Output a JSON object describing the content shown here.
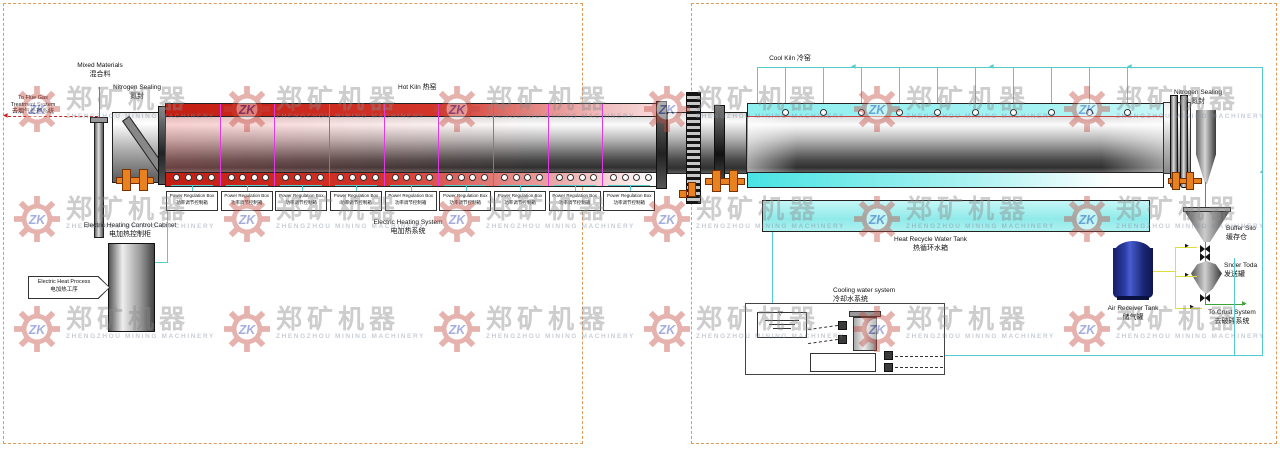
{
  "watermark": {
    "logo": "ZK",
    "brand_cn": "郑矿机器",
    "brand_en": "ZHENGZHOU MINING MACHINERY",
    "rows": 3,
    "cols": 6
  },
  "left": {
    "mixed_materials": {
      "en": "Mixed Materials",
      "cn": "混合料"
    },
    "flue_gas": {
      "l1": "To Flue Gas",
      "l2": "Treatment System",
      "cn": "去烟气处理系统"
    },
    "nitrogen_sealing": {
      "en": "Nitrogen Sealing",
      "cn": "氮封"
    },
    "hot_kiln": {
      "en": "Hot Kiln",
      "cn": "热窑"
    },
    "heating_zones": 9,
    "power_box": {
      "en": "Power Regulation Box",
      "cn": "功率调节控制箱"
    },
    "electric_heating_system": {
      "en": "Electric Heating System",
      "cn": "电加热系统"
    },
    "control_cabinet": {
      "en": "Electric Heating Control Cabinet",
      "cn": "电加热控制柜"
    },
    "heat_process": {
      "en": "Electric Heat Process",
      "cn": "电加热工序"
    }
  },
  "right": {
    "cool_kiln": {
      "en": "Cool Kiln",
      "cn": "冷窑"
    },
    "nitrogen_sealing": {
      "en": "Nitrogen Sealing",
      "cn": "氮封"
    },
    "water_tank": {
      "en": "Heat Recycle Water Tank",
      "cn": "热循环水箱"
    },
    "cooling_system": {
      "en": "Cooling water system",
      "cn": "冷却水系统"
    },
    "air_tank": {
      "en": "Air Receiver Tank",
      "cn": "储气罐"
    },
    "buffer_silo": {
      "en": "Buffer Silo",
      "cn": "缓存仓"
    },
    "sender_tank": {
      "en": "Snder Toda",
      "cn": "发送罐"
    },
    "to_crush": {
      "en": "To Crust System",
      "cn": "去破碎系统"
    },
    "spray_nozzles": 10
  },
  "colors": {
    "hot_red": "#d23020",
    "cool_cyan": "#8fefef",
    "pipe_cyan": "#55cccc",
    "flow_green": "#3aa53a",
    "air_yellow": "#dede3c",
    "zone_magenta": "#e23ae2",
    "roller_orange": "#e8821e",
    "border_dashed": "#e09a5a",
    "tank_blue": "#27379e"
  }
}
